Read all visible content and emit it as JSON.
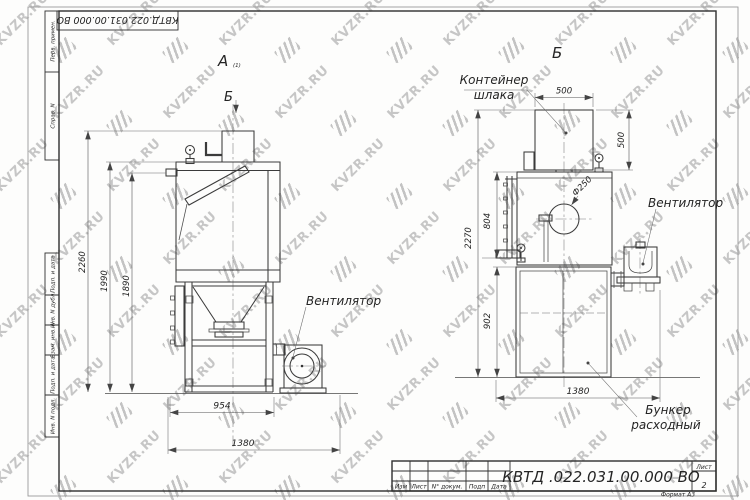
{
  "watermark": {
    "text": "KVZR.RU"
  },
  "stamp": {
    "doc_number": "КВТД .022.031.00.000  ВО",
    "top_doc_number": "КВТД.022.031.00.000  ВО",
    "sheet_label": "Лист",
    "sheet_number": "2",
    "format_label": "Формат А3",
    "revision_labels": [
      "Изм",
      "Лист",
      "N° докум.",
      "Подп",
      "Дата"
    ]
  },
  "frame_side": {
    "perv": "Перв. примен.",
    "sprav": "Справ. N",
    "podp1": "Подп. и дата",
    "inv_dubl": "Инв. N дубл.",
    "vzam": "Взам. инв. N",
    "podp2": "Подп. и дата",
    "inv_podl": "Инв. N подл."
  },
  "view_a": {
    "label": "А",
    "label_sub": "(1)",
    "section_mark": "Б",
    "fan_label": "Вентилятор",
    "dim_total_height": "2260",
    "dim_body_height": "1990",
    "dim_inner_height": "1890",
    "dim_leg_span": "954",
    "dim_total_width": "1380"
  },
  "view_b": {
    "label": "Б",
    "container_label": [
      "Контейнер",
      "шлака"
    ],
    "fan_label": "Вентилятор",
    "hopper_label": [
      "Бункер",
      "расходный"
    ],
    "dim_container_width": "500",
    "dim_container_height": "500",
    "dim_diameter": "Ф250",
    "dim_total_height": "2270",
    "dim_ladder_height": "804",
    "dim_hopper_height": "902",
    "dim_total_width": "1380"
  }
}
